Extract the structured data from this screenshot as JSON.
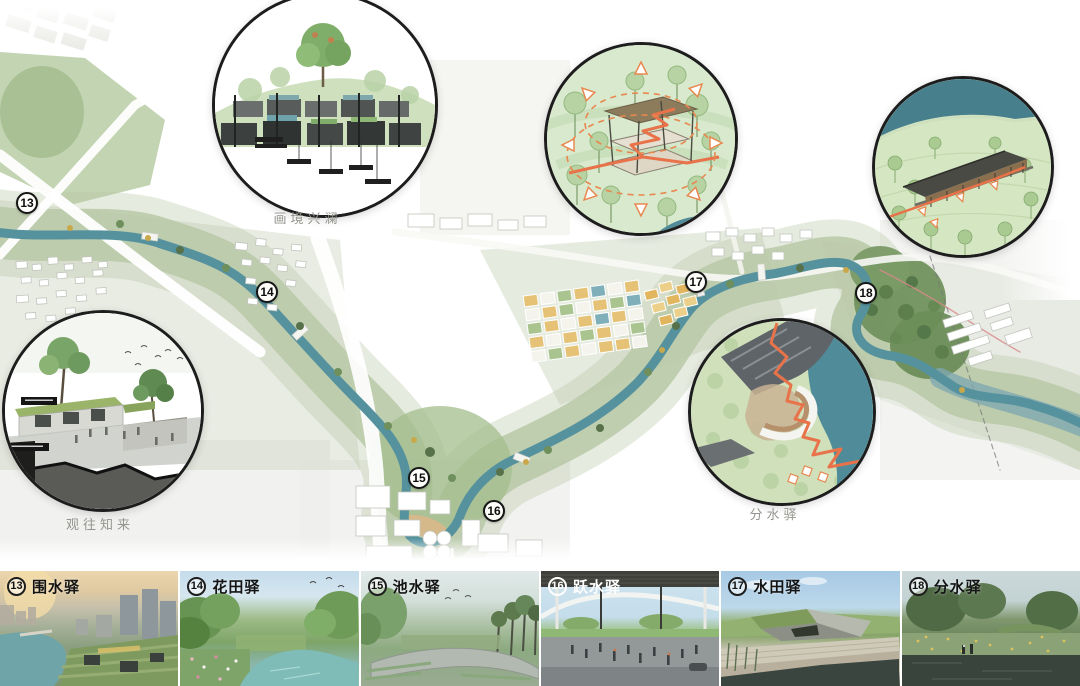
{
  "map": {
    "markers": [
      {
        "number": "13"
      },
      {
        "number": "14"
      },
      {
        "number": "15"
      },
      {
        "number": "16"
      },
      {
        "number": "17"
      },
      {
        "number": "18"
      }
    ],
    "callout_labels": {
      "garden_section": "画境兴澜",
      "heritage_view": "观往知来",
      "fenshui_station": "分水驿"
    }
  },
  "gallery": {
    "items": [
      {
        "number": "13",
        "name": "围水驿"
      },
      {
        "number": "14",
        "name": "花田驿"
      },
      {
        "number": "15",
        "name": "池水驿"
      },
      {
        "number": "16",
        "name": "跃水驿"
      },
      {
        "number": "17",
        "name": "水田驿"
      },
      {
        "number": "18",
        "name": "分水驿"
      }
    ]
  },
  "colors": {
    "river_teal": "#55929e",
    "greenway_green": "#b6c7a4",
    "route_orange": "#e8734a",
    "field_yellow": "#e6c277",
    "forest_green": "#71925e",
    "marker_outline": "#161616"
  }
}
